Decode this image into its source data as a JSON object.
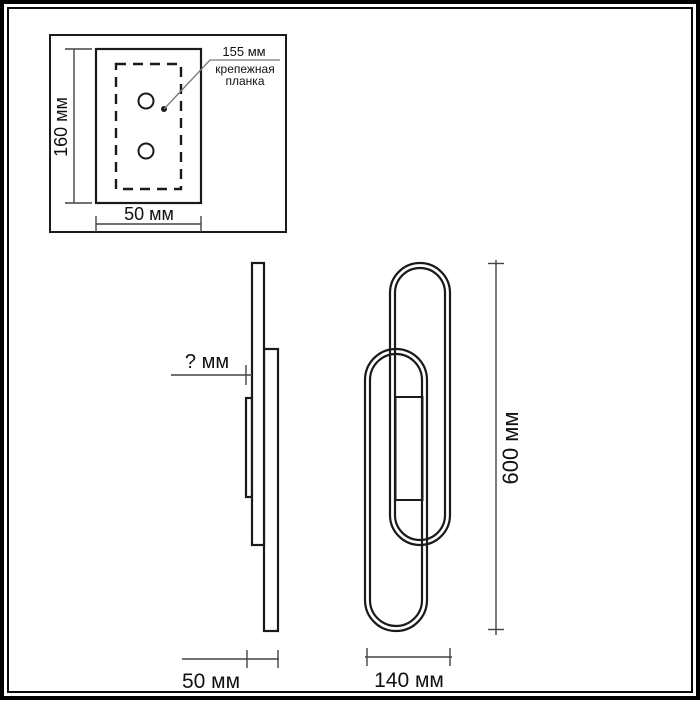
{
  "title": "wall-lamp-dimension-drawing",
  "colors": {
    "line": "#1a1a1a",
    "dimension_line": "#444444",
    "leader_line": "#777777",
    "background": "#ffffff"
  },
  "inset": {
    "height_dim": "160 мм",
    "width_dim": "50 мм",
    "bracket_dim": "155 мм",
    "bracket_label_line1": "крепежная",
    "bracket_label_line2": "планка"
  },
  "side_view": {
    "projection_dim": "? мм",
    "depth_dim": "50 мм"
  },
  "front_view": {
    "height_dim": "600 мм",
    "width_dim": "140 мм"
  }
}
